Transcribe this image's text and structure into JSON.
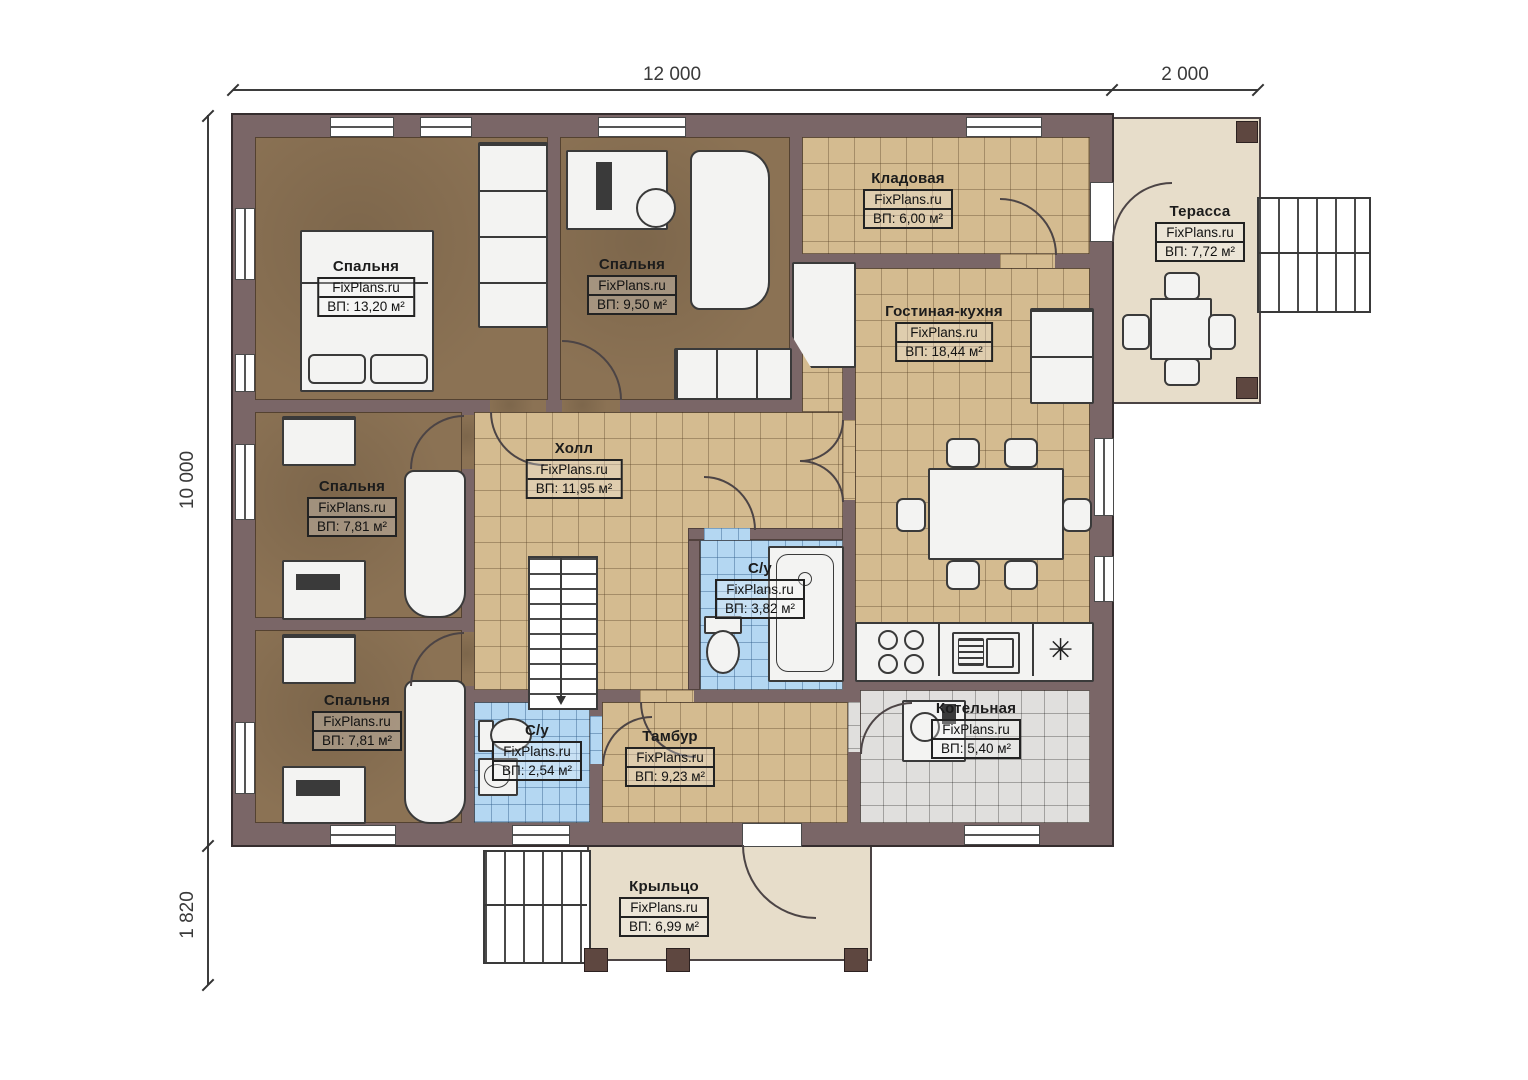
{
  "dimensions": {
    "top_main": "12 000",
    "top_right": "2 000",
    "left_main": "10 000",
    "left_bottom": "1 820"
  },
  "rooms": [
    {
      "name": "Спальня",
      "watermark": "FixPlans.ru",
      "area": "ВП: 13,20 м²"
    },
    {
      "name": "Спальня",
      "watermark": "FixPlans.ru",
      "area": "ВП: 9,50 м²"
    },
    {
      "name": "Кладовая",
      "watermark": "FixPlans.ru",
      "area": "ВП: 6,00 м²"
    },
    {
      "name": "Терасса",
      "watermark": "FixPlans.ru",
      "area": "ВП: 7,72 м²"
    },
    {
      "name": "Гостиная-кухня",
      "watermark": "FixPlans.ru",
      "area": "ВП: 18,44 м²"
    },
    {
      "name": "Холл",
      "watermark": "FixPlans.ru",
      "area": "ВП: 11,95 м²"
    },
    {
      "name": "Спальня",
      "watermark": "FixPlans.ru",
      "area": "ВП: 7,81 м²"
    },
    {
      "name": "С/у",
      "watermark": "FixPlans.ru",
      "area": "ВП: 3,82 м²"
    },
    {
      "name": "Спальня",
      "watermark": "FixPlans.ru",
      "area": "ВП: 7,81 м²"
    },
    {
      "name": "С/у",
      "watermark": "FixPlans.ru",
      "area": "ВП: 2,54 м²"
    },
    {
      "name": "Тамбур",
      "watermark": "FixPlans.ru",
      "area": "ВП: 9,23 м²"
    },
    {
      "name": "Котельная",
      "watermark": "FixPlans.ru",
      "area": "ВП: 5,40 м²"
    },
    {
      "name": "Крыльцо",
      "watermark": "FixPlans.ru",
      "area": "ВП: 6,99 м²"
    }
  ],
  "symbols": {
    "asterisk": "✳"
  },
  "colors": {
    "wall": "#7a6667",
    "bedroom_floor": "#8b7254",
    "tile_tan": "#d4bb90",
    "tile_blue": "#b4d7f2",
    "tile_gray": "#e0dfdd",
    "deck": "#e7ddca",
    "pillar": "#5e4740"
  }
}
